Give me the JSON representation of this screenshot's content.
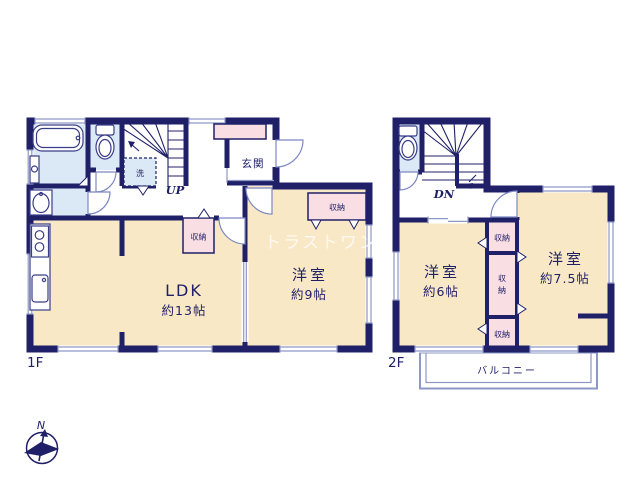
{
  "watermark": "トラストワン",
  "compass": {
    "north_label": "N"
  },
  "colors": {
    "wall_navy": "#1f2068",
    "room_beige": "#f8e8c6",
    "closet_pink": "#f9dee3",
    "wet_area_blue": "#dbe8f6",
    "thin_line": "#8e98c6"
  },
  "floor1": {
    "floor_label": "1F",
    "ldk_name": "LDK",
    "ldk_size": "約13帖",
    "bedroom_name": "洋室",
    "bedroom_size": "約9帖",
    "entrance_label": "玄関",
    "hall_storage_label": "収納",
    "bedroom_storage_label": "収納",
    "laundry_label": "洗",
    "stairs_label": "UP"
  },
  "floor2": {
    "floor_label": "2F",
    "bedroom6_name": "洋室",
    "bedroom6_size": "約6帖",
    "bedroom75_name": "洋室",
    "bedroom75_size": "約7.5帖",
    "storage_top_label": "収納",
    "storage_mid_char1": "収",
    "storage_mid_char2": "納",
    "storage_bottom_label": "収納",
    "balcony_label": "バルコニー",
    "stairs_label": "DN"
  }
}
